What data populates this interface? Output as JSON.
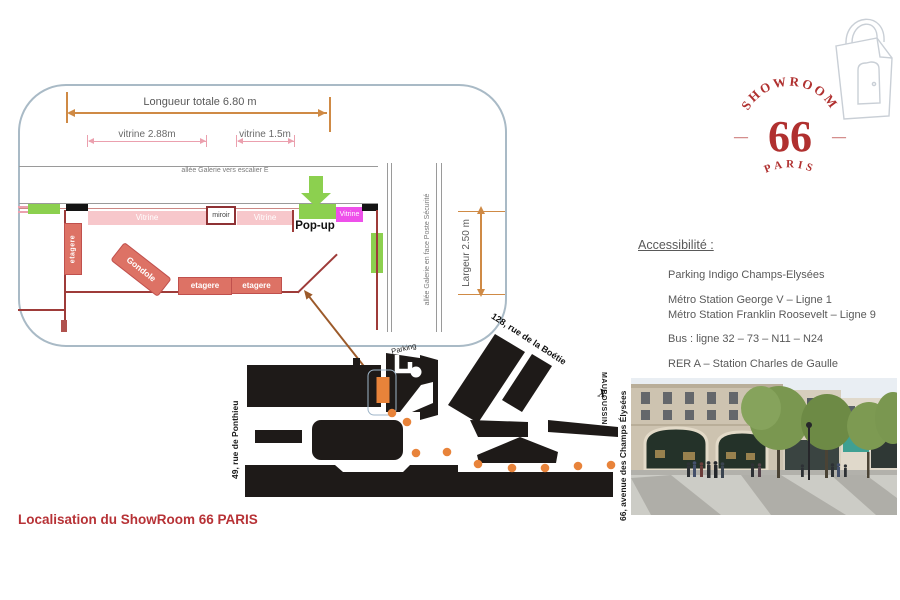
{
  "plan": {
    "dim_total": "Longueur totale  6.80 m",
    "dim_vitrine_left": "vitrine 2.88m",
    "dim_vitrine_right": "vitrine 1.5m",
    "dim_width": "Largeur 2.50 m",
    "allee_top": "allée Galerie vers escalier E",
    "allee_right": "allée Galerie en face Poste Sécurité",
    "labels": {
      "vitrine": "Vitrine",
      "vitrine_magenta": "Vitrine",
      "miroir": "miroir",
      "popup": "Pop-up",
      "etagere": "etagere",
      "gondole": "Gondole"
    }
  },
  "logo": {
    "arc_text": "SHOWROOM",
    "number": "66",
    "dash": "—",
    "city": "PARIS"
  },
  "accessibility": {
    "title": "Accessibilité :",
    "items": [
      "Parking Indigo Champs-Elysées",
      "Métro Station George V – Ligne 1",
      "Métro Station Franklin Roosevelt – Ligne 9",
      "Bus : ligne 32 – 73 – N11 – N24",
      "RER A – Station Charles de Gaulle"
    ]
  },
  "map": {
    "labels": {
      "parking": "Parking",
      "rue_boetie": "128, rue de la Boétie",
      "rue_ponthieu": "49, rue de Ponthieu",
      "avenue": "66, avenue des Champs Élysées",
      "mauboussin": "MAUBOUSSIN",
      "x_mark": "X"
    }
  },
  "caption": "Localisation du ShowRoom 66 PARIS",
  "colors": {
    "logo_red": "#B0302F",
    "caption_red": "#B73236",
    "green": "#8CD04F",
    "salmon": "#DD7265",
    "pink_light": "#F7C7CB",
    "magenta": "#EE50EA",
    "dim_orange": "#CF8A45",
    "dim_pink": "#EBA0AE",
    "wall_red": "#9E3B39",
    "map_black": "#1E1A18",
    "map_orange": "#E8833A",
    "text_gray": "#595959"
  },
  "icons": {
    "logo_bag": "shopping-bag-icon",
    "popup_arrow": "down-arrow-icon",
    "map_path": "orange-dots-path",
    "annotation": "annotation-arrow"
  }
}
